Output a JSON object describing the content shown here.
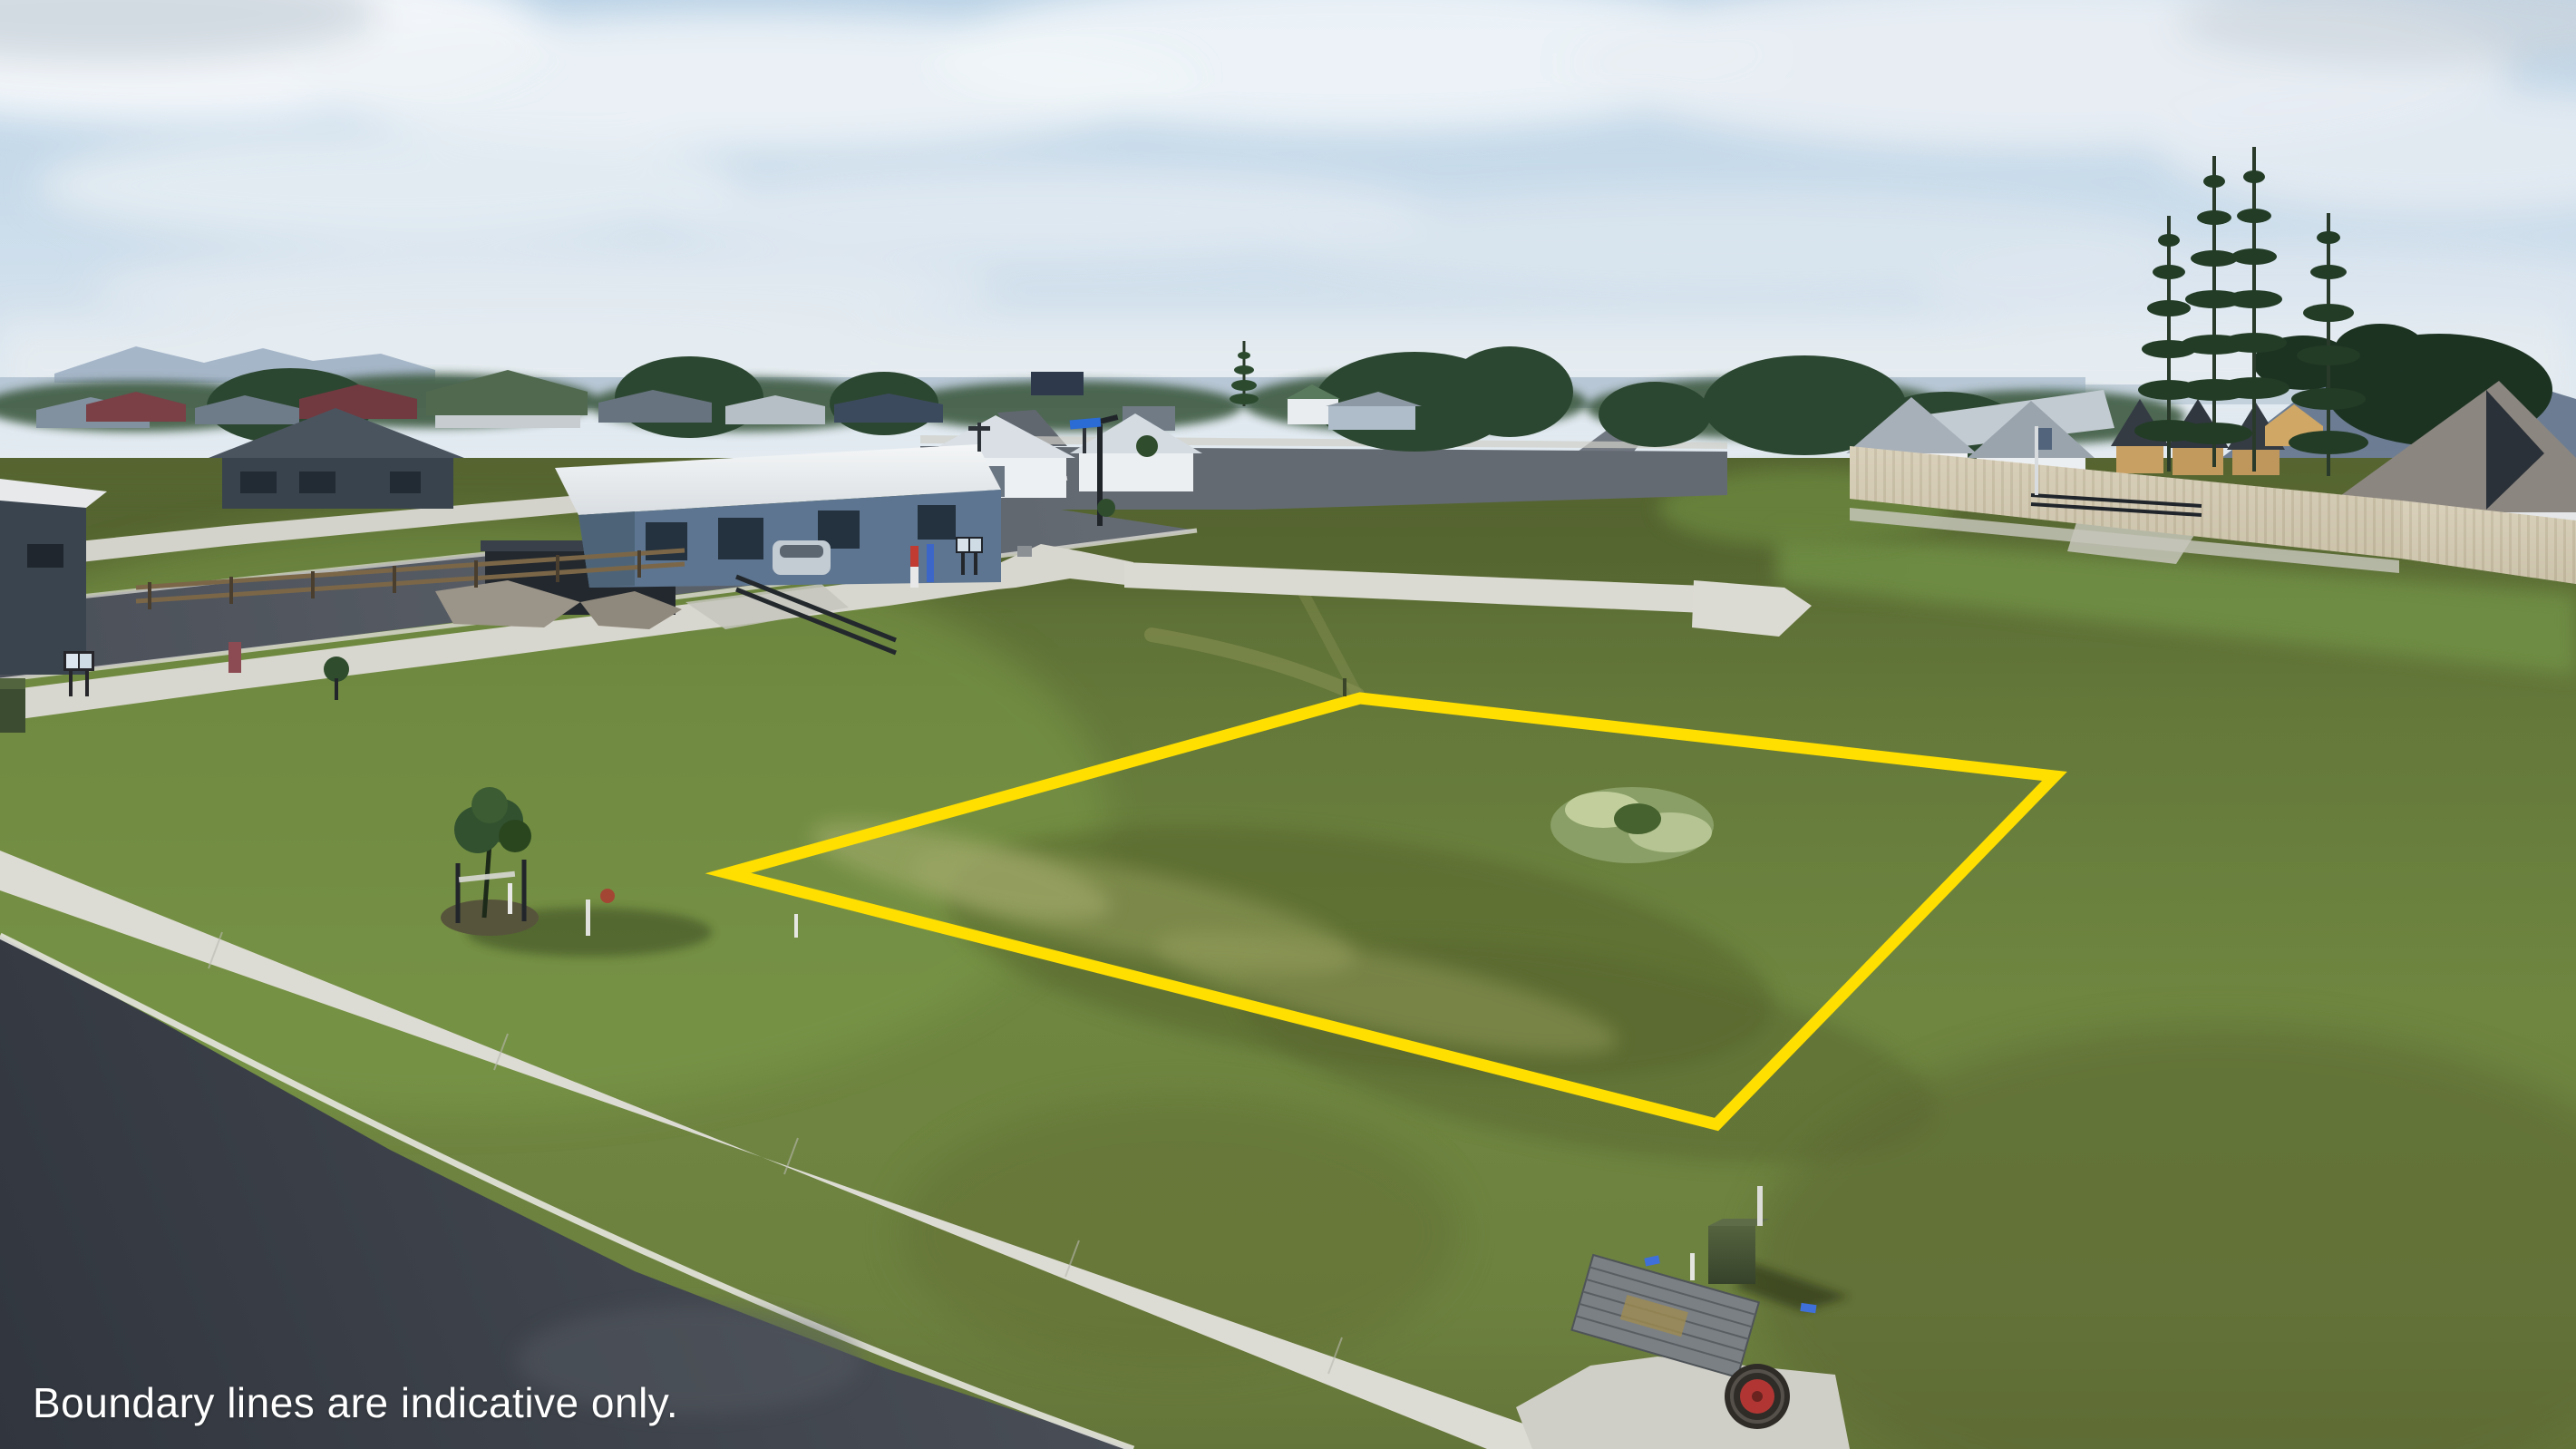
{
  "overlay": {
    "disclaimer": "Boundary lines are indicative only.",
    "text_color": "#ffffff"
  },
  "boundary": {
    "color": "#ffdf00",
    "stroke_width": 13,
    "points": [
      [
        1500,
        770
      ],
      [
        2266,
        856
      ],
      [
        1893,
        1240
      ],
      [
        803,
        963
      ]
    ]
  },
  "palette": {
    "sky_top": "#bdd5e7",
    "sky_horizon": "#e6edf2",
    "cloud": "#f3f6f8",
    "sea": "#b3c3d2",
    "field": "#6a7e3e",
    "field_bright": "#7fa148",
    "field_olive": "#59682f",
    "road": "#565c64",
    "road_dark": "#3a3f47",
    "concrete_path": "#d8d7cf",
    "curb": "#e9e8e2",
    "paling_fence": "#d5ccb6",
    "roof_white": "#eef1f3",
    "house_blue": "#5d7590",
    "treeline": "#2c4731",
    "pine": "#233c26",
    "manhole_red": "#b13633"
  }
}
